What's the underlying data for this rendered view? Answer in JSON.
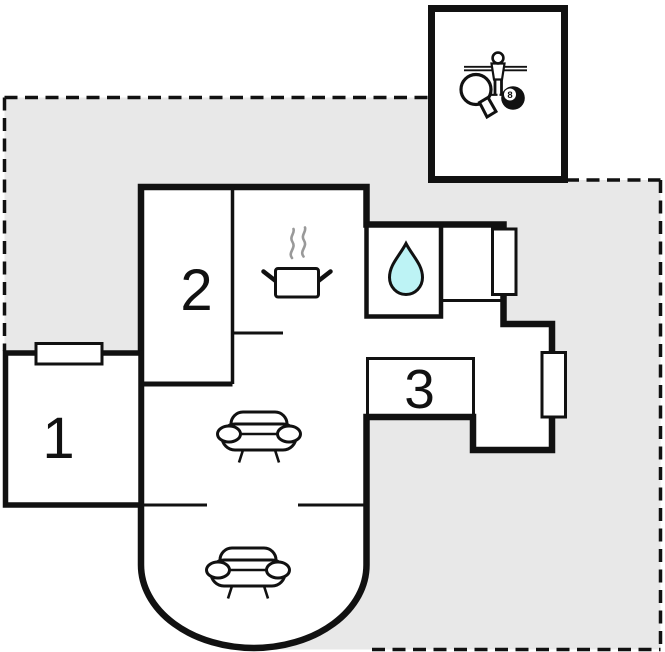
{
  "floor_plan": {
    "rooms": [
      {
        "label": "1"
      },
      {
        "label": "2"
      },
      {
        "label": "3"
      }
    ],
    "kitchen": {
      "icon": "steaming-pot-icon"
    },
    "bathroom": {
      "icon": "water-drop-icon"
    },
    "living_room": {
      "icon": "sofa-icon",
      "sofa_count": 2
    },
    "game_room": {
      "icons": [
        "foosball-player-icon",
        "table-tennis-paddle-icon",
        "eight-ball-icon"
      ],
      "eight_ball_label": "8"
    },
    "windows": {
      "count": 3,
      "icon": "window-icon"
    },
    "colors": {
      "wall": "#111111",
      "plot_fill": "#e8e8e8",
      "water_drop_fill": "#bdf3f5",
      "steam": "#999999",
      "window_fill": "#ffffff",
      "room_fill": "#ffffff"
    }
  }
}
